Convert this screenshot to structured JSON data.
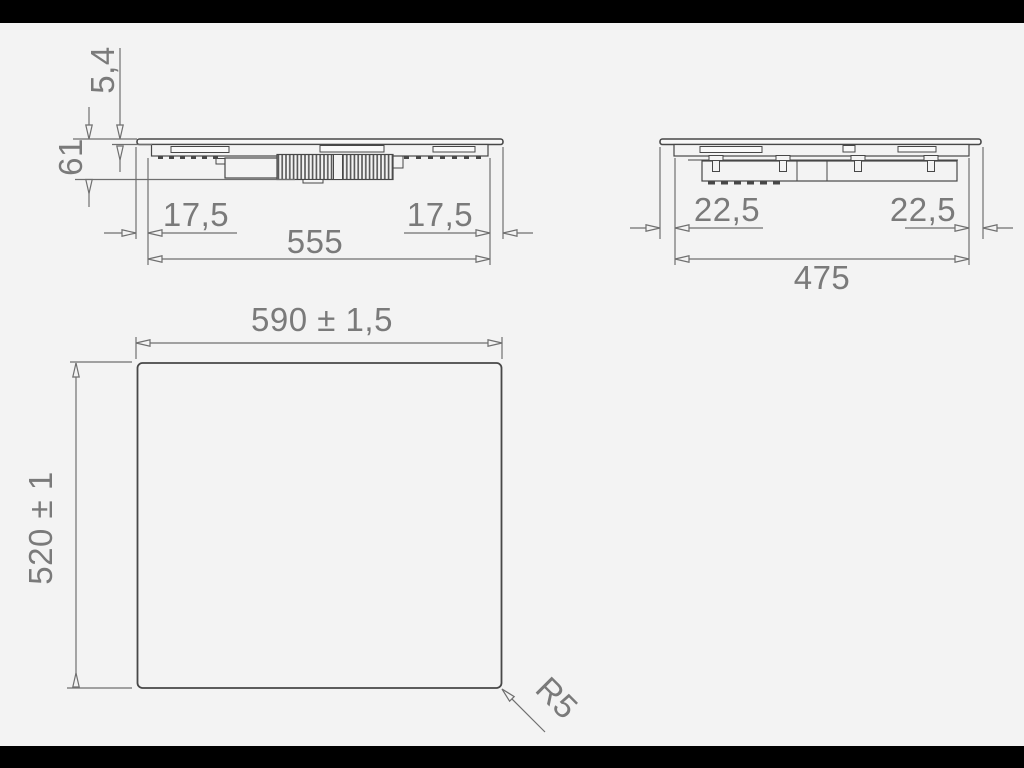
{
  "drawing": {
    "title": "hob-installation-dimension-drawing",
    "colors": {
      "background": "#f3f3f3",
      "letterbox": "#000000",
      "object_line": "#474747",
      "dimension_line": "#6f6f6f",
      "text": "#7a7a7a"
    },
    "front_view": {
      "glass_thickness_label": "5,4",
      "total_height_label": "61",
      "left_inset_label": "17,5",
      "right_inset_label": "17,5",
      "body_width_label": "555"
    },
    "side_view": {
      "left_inset_label": "22,5",
      "right_inset_label": "22,5",
      "body_depth_label": "475"
    },
    "top_view": {
      "width_label": "590 ± 1,5",
      "depth_label": "520 ± 1",
      "corner_radius_label": "R5"
    }
  }
}
